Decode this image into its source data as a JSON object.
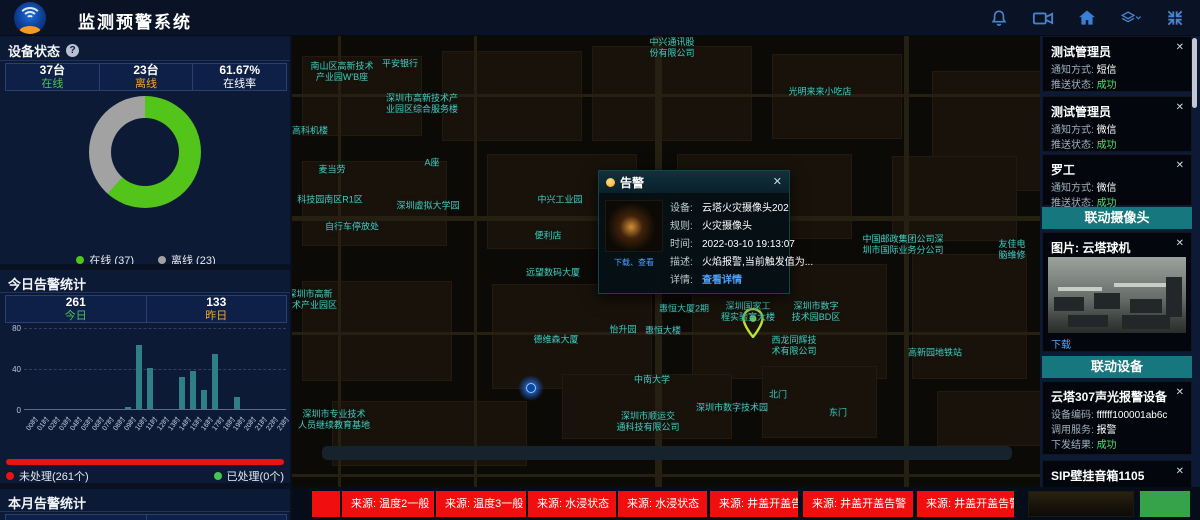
{
  "ui": {
    "close_glyph": "✕",
    "help_glyph": "?"
  },
  "header": {
    "title": "监测预警系统",
    "icons": [
      "bell",
      "video-camera",
      "home",
      "layers",
      "fullscreen"
    ]
  },
  "device_status": {
    "title": "设备状态",
    "stats": [
      {
        "value": "37台",
        "label": "在线",
        "color": "green"
      },
      {
        "value": "23台",
        "label": "离线",
        "color": "orange"
      },
      {
        "value": "61.67%",
        "label": "在线率",
        "color": "white"
      }
    ],
    "donut_chart": {
      "type": "pie",
      "slices": [
        {
          "label": "在线",
          "value": 37,
          "color": "#52c41a"
        },
        {
          "label": "离线",
          "value": 23,
          "color": "#a2a2a2"
        }
      ],
      "online_rate_pct": 61.67
    },
    "legend": [
      {
        "label": "在线 (37)",
        "color": "#52c41a"
      },
      {
        "label": "离线 (23)",
        "color": "#a2a2a2"
      }
    ]
  },
  "today_alarms": {
    "title": "今日告警统计",
    "stats": [
      {
        "value": "261",
        "label": "今日",
        "color": "green"
      },
      {
        "value": "133",
        "label": "昨日",
        "color": "orange"
      }
    ],
    "chart_data": {
      "type": "bar",
      "categories": [
        "00时",
        "01时",
        "02时",
        "03时",
        "04时",
        "05时",
        "06时",
        "07时",
        "08时",
        "09时",
        "10时",
        "11时",
        "12时",
        "13时",
        "14时",
        "15时",
        "16时",
        "17时",
        "18时",
        "19时",
        "20时",
        "21时",
        "22时",
        "23时"
      ],
      "values": [
        0,
        0,
        0,
        0,
        0,
        0,
        0,
        0,
        0,
        2,
        62,
        40,
        0,
        0,
        31,
        37,
        19,
        54,
        0,
        12,
        0,
        0,
        0,
        0
      ],
      "ylim": [
        0,
        80
      ],
      "yticks": [
        0,
        40,
        80
      ],
      "bar_color": "#2e7f86"
    },
    "progress": {
      "unprocessed_label": "未处理(261个)",
      "processed_label": "已处理(0个)",
      "unprocessed_pct": 100
    }
  },
  "month_alarms": {
    "title": "本月告警统计",
    "stats": [
      {
        "value": "763"
      },
      {
        "value": "1146"
      }
    ]
  },
  "map": {
    "labels": [
      {
        "x": 380,
        "y": 12,
        "text": "中兴通讯股\n份有限公司"
      },
      {
        "x": 528,
        "y": 56,
        "text": "光明来来小吃店"
      },
      {
        "x": 50,
        "y": 36,
        "text": "南山区高新技术\n产业园W'B座"
      },
      {
        "x": 108,
        "y": 28,
        "text": "平安银行"
      },
      {
        "x": 130,
        "y": 68,
        "text": "深圳市高新技术产\n业园区综合服务楼"
      },
      {
        "x": 18,
        "y": 95,
        "text": "高科机楼"
      },
      {
        "x": 40,
        "y": 134,
        "text": "麦当劳"
      },
      {
        "x": 140,
        "y": 127,
        "text": "A座"
      },
      {
        "x": 38,
        "y": 164,
        "text": "科技园南区R1区"
      },
      {
        "x": 136,
        "y": 170,
        "text": "深圳虚拟大学园"
      },
      {
        "x": 60,
        "y": 191,
        "text": "自行车停放处"
      },
      {
        "x": 268,
        "y": 164,
        "text": "中兴工业园"
      },
      {
        "x": 256,
        "y": 200,
        "text": "便利店"
      },
      {
        "x": 261,
        "y": 237,
        "text": "远望数码大厦"
      },
      {
        "x": 18,
        "y": 264,
        "text": "深圳市高新\n技术产业园区"
      },
      {
        "x": 264,
        "y": 304,
        "text": "德维森大厦"
      },
      {
        "x": 331,
        "y": 294,
        "text": "怡升园"
      },
      {
        "x": 371,
        "y": 295,
        "text": "惠恒大楼"
      },
      {
        "x": 392,
        "y": 273,
        "text": "惠恒大厦2期"
      },
      {
        "x": 456,
        "y": 276,
        "text": "深圳国家工\n程实验室大楼"
      },
      {
        "x": 524,
        "y": 276,
        "text": "深圳市数字\n技术园BD区"
      },
      {
        "x": 502,
        "y": 310,
        "text": "西龙同辉技\n术有限公司"
      },
      {
        "x": 611,
        "y": 209,
        "text": "中国邮政集团公司深\n圳市国际业务分公司"
      },
      {
        "x": 720,
        "y": 214,
        "text": "友佳电脑维修"
      },
      {
        "x": 360,
        "y": 344,
        "text": "中南大学"
      },
      {
        "x": 440,
        "y": 372,
        "text": "深圳市数字技术园"
      },
      {
        "x": 486,
        "y": 359,
        "text": "北门"
      },
      {
        "x": 546,
        "y": 377,
        "text": "东门"
      },
      {
        "x": 356,
        "y": 386,
        "text": "深圳市顺运交\n通科技有限公司"
      },
      {
        "x": 643,
        "y": 317,
        "text": "高新园地铁站"
      },
      {
        "x": 42,
        "y": 384,
        "text": "深圳市专业技术\n人员继续教育基地"
      }
    ],
    "markers": {
      "blue_dot": {
        "x": 239,
        "y": 352
      },
      "green_pin": {
        "x": 461,
        "y": 307
      }
    },
    "popup": {
      "title": "告警",
      "thumb_links": "下载、查看",
      "rows": [
        {
          "label": "设备:",
          "value": "云塔火灾摄像头202"
        },
        {
          "label": "规则:",
          "value": "火灾摄像头"
        },
        {
          "label": "时间:",
          "value": "2022-03-10 19:13:07"
        },
        {
          "label": "描述:",
          "value": "火焰报警,当前触发值为..."
        },
        {
          "label": "详情:",
          "value": "查看详情",
          "link": true
        }
      ]
    }
  },
  "right_panel": {
    "notifications": [
      {
        "name": "测试管理员",
        "rows": [
          {
            "label": "通知方式: ",
            "value": "短信"
          },
          {
            "label": "推送状态: ",
            "value": "成功",
            "success": true
          }
        ]
      },
      {
        "name": "测试管理员",
        "rows": [
          {
            "label": "通知方式: ",
            "value": "微信"
          },
          {
            "label": "推送状态: ",
            "value": "成功",
            "success": true
          }
        ]
      },
      {
        "name": "罗工",
        "rows": [
          {
            "label": "通知方式: ",
            "value": "微信"
          },
          {
            "label": "推送状态: ",
            "value": "成功",
            "success": true
          }
        ]
      }
    ],
    "camera_section": {
      "header": "联动摄像头",
      "card_title": "图片: 云塔球机",
      "download": "下载"
    },
    "device_section": {
      "header": "联动设备",
      "devices": [
        {
          "name": "云塔307声光报警设备",
          "rows": [
            {
              "label": "设备编码: ",
              "value": "ffffff100001ab6c"
            },
            {
              "label": "调用服务: ",
              "value": "报警"
            },
            {
              "label": "下发结果: ",
              "value": "成功",
              "success": true
            }
          ]
        },
        {
          "name": "SIP壁挂音箱1105",
          "rows": [
            {
              "label": "设备编码: ",
              "value": "1105"
            }
          ]
        }
      ]
    }
  },
  "ticker": {
    "items": [
      "",
      "来源: 温度2一般",
      "来源: 温度3一般",
      "来源: 水浸状态",
      "来源: 水浸状态",
      "来源: 井盖开盖告警",
      "来源: 井盖开盖告警",
      "来源: 井盖开盖告警"
    ]
  }
}
